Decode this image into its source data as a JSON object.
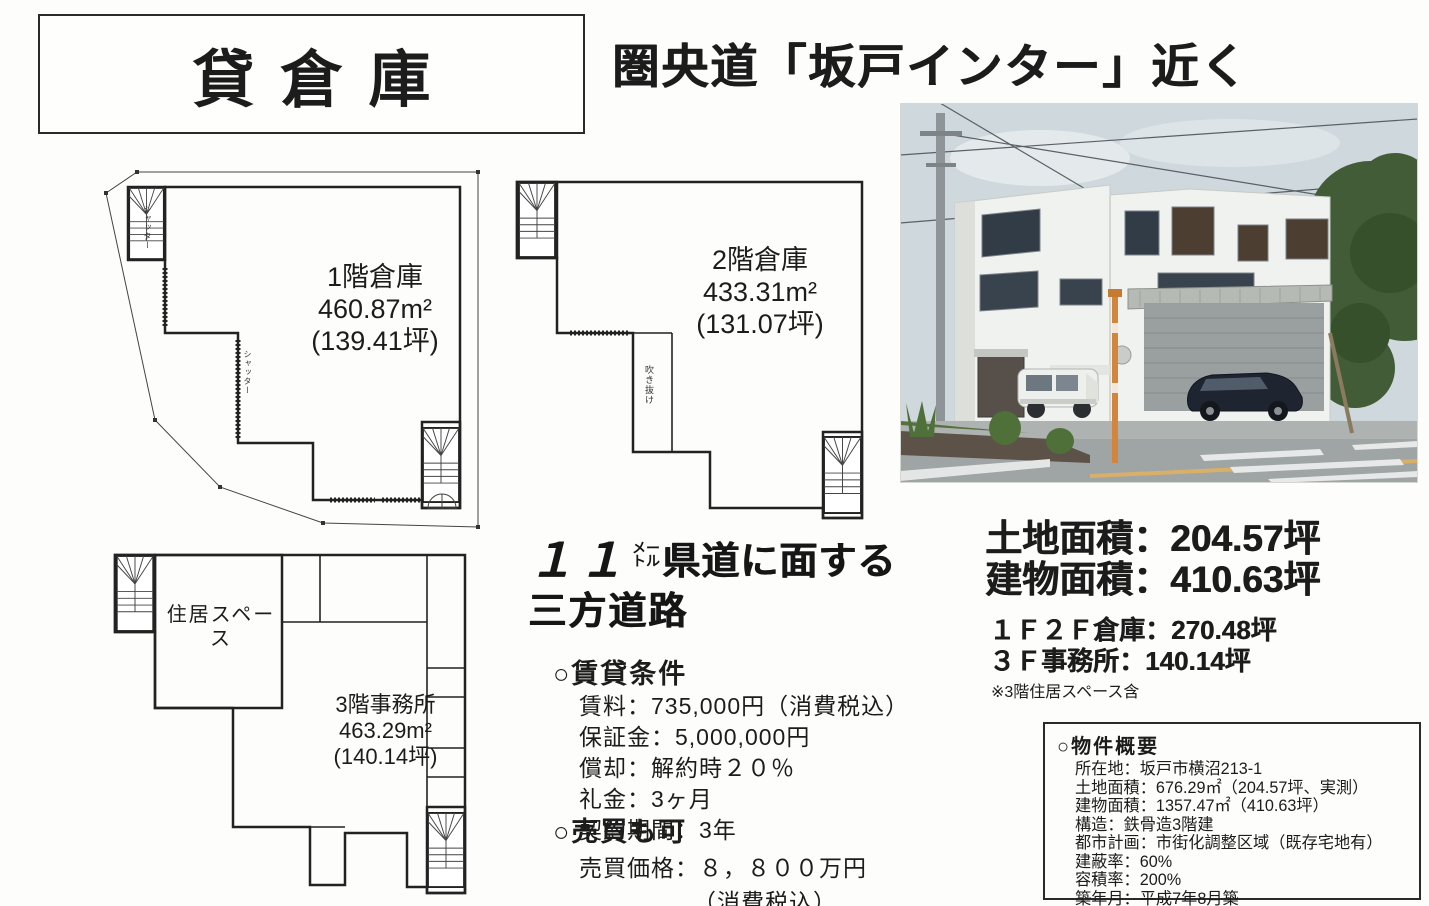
{
  "title": "貸倉庫",
  "headline": "圏央道「坂戸インター」近く",
  "plans": {
    "f1": {
      "name": "1階倉庫",
      "area": "460.87m²",
      "tsubo": "(139.41坪)",
      "shutter": "シャッター"
    },
    "f2": {
      "name": "2階倉庫",
      "area": "433.31m²",
      "tsubo": "(131.07坪)",
      "void_label": "吹き抜け"
    },
    "f3": {
      "name": "3階事務所",
      "area": "463.29m²",
      "tsubo": "(140.14坪)",
      "residence": "住居スペース"
    }
  },
  "road_note": {
    "number": "１１",
    "unit_top": "メー",
    "unit_bottom": "トル",
    "line1": "県道に面する",
    "line2": "三方道路"
  },
  "areas": {
    "land": "土地面積：204.57坪",
    "building": "建物面積：410.63坪",
    "warehouse_12f": "１Ｆ２Ｆ倉庫：270.48坪",
    "office_3f": "３Ｆ事務所：140.14坪",
    "note": "※3階住居スペース含"
  },
  "rental": {
    "heading": "○賃貸条件",
    "items": [
      "賃料：735,000円（消費税込）",
      "保証金：5,000,000円",
      "償却：解約時２０％",
      "礼金：3ヶ月",
      "契約期間：3年"
    ]
  },
  "sale": {
    "heading": "○売買も可",
    "price": "売買価格：８，８００万円",
    "tax": "（消費税込）"
  },
  "summary": {
    "heading": "○物件概要",
    "items": [
      "所在地：坂戸市横沼213-1",
      "土地面積：676.29㎡（204.57坪、実測）",
      "建物面積：1357.47㎡（410.63坪）",
      "構造：鉄骨造3階建",
      "都市計画：市街化調整区域（既存宅地有）",
      "建蔽率：60%",
      "容積率：200%",
      "築年月：平成7年8月築"
    ]
  }
}
